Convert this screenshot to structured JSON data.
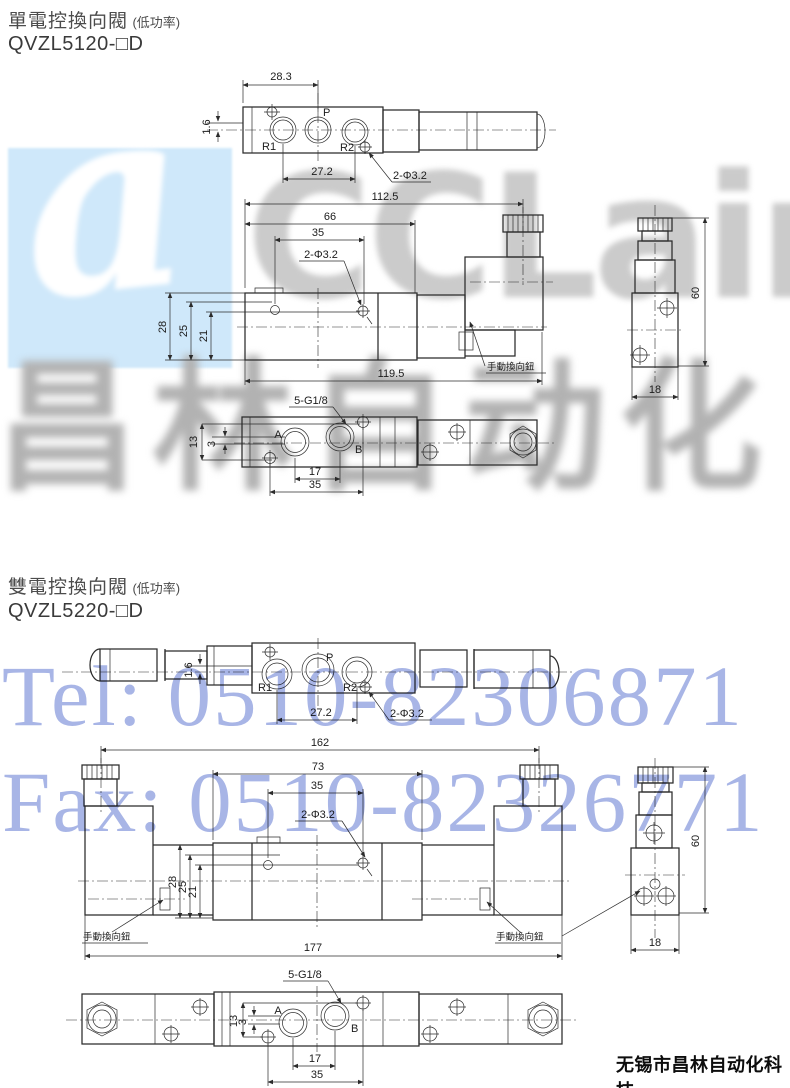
{
  "page": {
    "footer": "无锡市昌林自动化科技"
  },
  "watermarks": {
    "logo_glyph": "a",
    "logo_text": "CCLair",
    "brand_cn": "昌林自动化",
    "tel": "Tel: 0510-82306871",
    "fax": "Fax: 0510-82326771",
    "colors": {
      "logo_bg": "#cfe8fa",
      "gray_text": "#c0c0c0",
      "blue_text": "#3956c5"
    }
  },
  "section1": {
    "title": "單電控換向閥",
    "title_note": "(低功率)",
    "model": "QVZL5120-□D",
    "top_view": {
      "dim_28_3": "28.3",
      "dim_1_6": "1.6",
      "port_p": "P",
      "port_r1": "R1",
      "port_r2": "R2",
      "dim_27_2": "27.2",
      "holes": "2-Φ3.2"
    },
    "front_view": {
      "dim_112_5": "112.5",
      "dim_66": "66",
      "dim_35": "35",
      "holes": "2-Φ3.2",
      "dim_28": "28",
      "dim_25": "25",
      "dim_21": "21",
      "dim_119_5": "119.5",
      "manual_label": "手動換向鈕"
    },
    "side_view": {
      "dim_60": "60",
      "dim_18": "18"
    },
    "bottom_view": {
      "thread": "5-G1/8",
      "port_a": "A",
      "port_b": "B",
      "dim_13": "13",
      "dim_3": "3",
      "dim_17": "17",
      "dim_35": "35"
    }
  },
  "section2": {
    "title": "雙電控換向閥",
    "title_note": "(低功率)",
    "model": "QVZL5220-□D",
    "top_view": {
      "dim_1_6": "1.6",
      "port_p": "P",
      "port_r1": "R1",
      "port_r2": "R2",
      "dim_27_2": "27.2",
      "holes": "2-Φ3.2"
    },
    "front_view": {
      "dim_162": "162",
      "dim_73": "73",
      "dim_35": "35",
      "holes": "2-Φ3.2",
      "dim_28": "28",
      "dim_25": "25",
      "dim_21": "21",
      "dim_177": "177",
      "manual_left": "手動換向鈕",
      "manual_right": "手動換向鈕"
    },
    "side_view": {
      "dim_60": "60",
      "dim_18": "18"
    },
    "bottom_view": {
      "thread": "5-G1/8",
      "port_a": "A",
      "port_b": "B",
      "dim_13": "13",
      "dim_3": "3",
      "dim_17": "17",
      "dim_35": "35"
    }
  }
}
